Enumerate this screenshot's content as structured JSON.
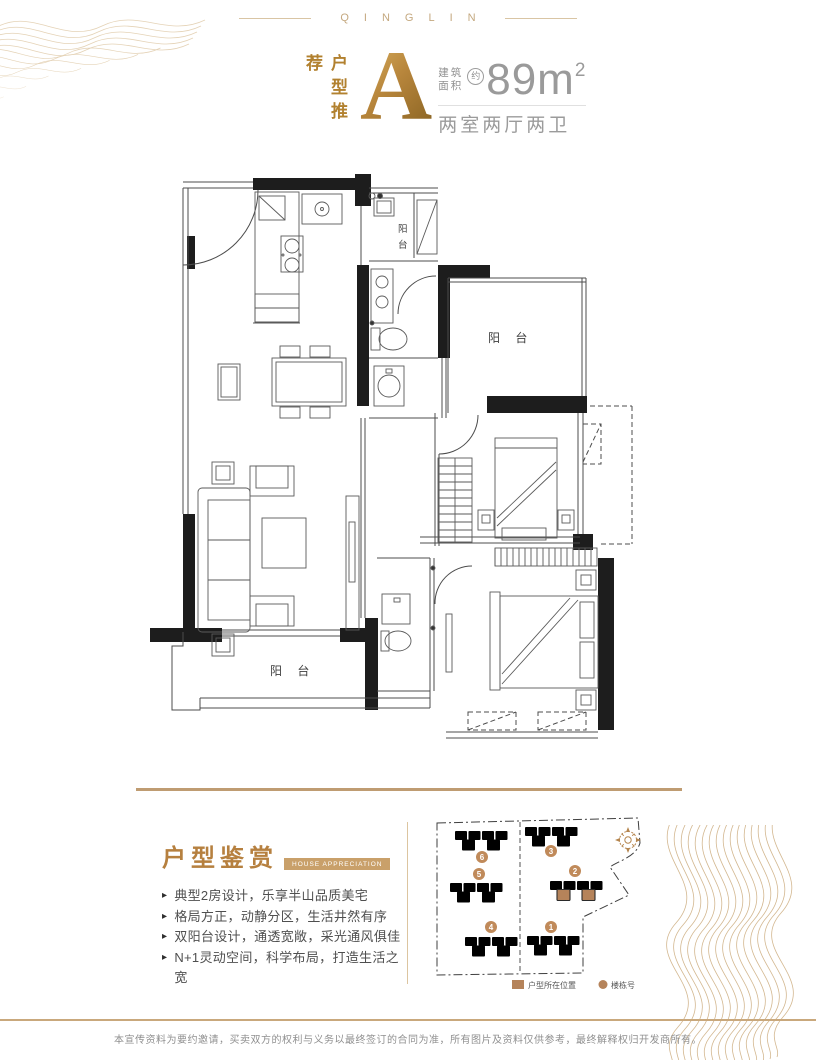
{
  "brand": {
    "name": "QINGLIN"
  },
  "header": {
    "recommend": "户型推荐",
    "unit_letter": "A",
    "area_label_line1": "建筑",
    "area_label_line2": "面积",
    "approx": "约",
    "area_value": "89m",
    "area_exponent": "2",
    "rooms": "两室两厅两卫"
  },
  "floorplan": {
    "balcony_top": "阳 台",
    "balcony_mid_char1": "阳",
    "balcony_mid_char2": "台",
    "balcony_bottom": "阳 台"
  },
  "appreciation": {
    "title": "户型鉴赏",
    "tag": "HOUSE APPRECIATION",
    "bullets": [
      "典型2房设计，乐享半山品质美宅",
      "格局方正，动静分区，生活井然有序",
      "双阳台设计，通透宽敞，采光通风俱佳",
      "N+1灵动空间，科学布局，打造生活之宽"
    ]
  },
  "siteplan": {
    "buildings": [
      {
        "number": "6"
      },
      {
        "number": "5"
      },
      {
        "number": "4"
      },
      {
        "number": "3"
      },
      {
        "number": "2"
      },
      {
        "number": "1"
      }
    ],
    "legend_location": "户型所在位置",
    "legend_building": "楼栋号"
  },
  "footer": {
    "disclaimer": "本宣传资料为要约邀请，买卖双方的权利与义务以最终签订的合同为准，所有图片及资料仅供参考，最终解释权归开发商所有。"
  },
  "colors": {
    "gold": "#b6803f",
    "tan_line": "#c9a87c",
    "highlight": "#b5835a",
    "gray_text": "#9a9a9a",
    "wall": "#1d1d1d"
  }
}
